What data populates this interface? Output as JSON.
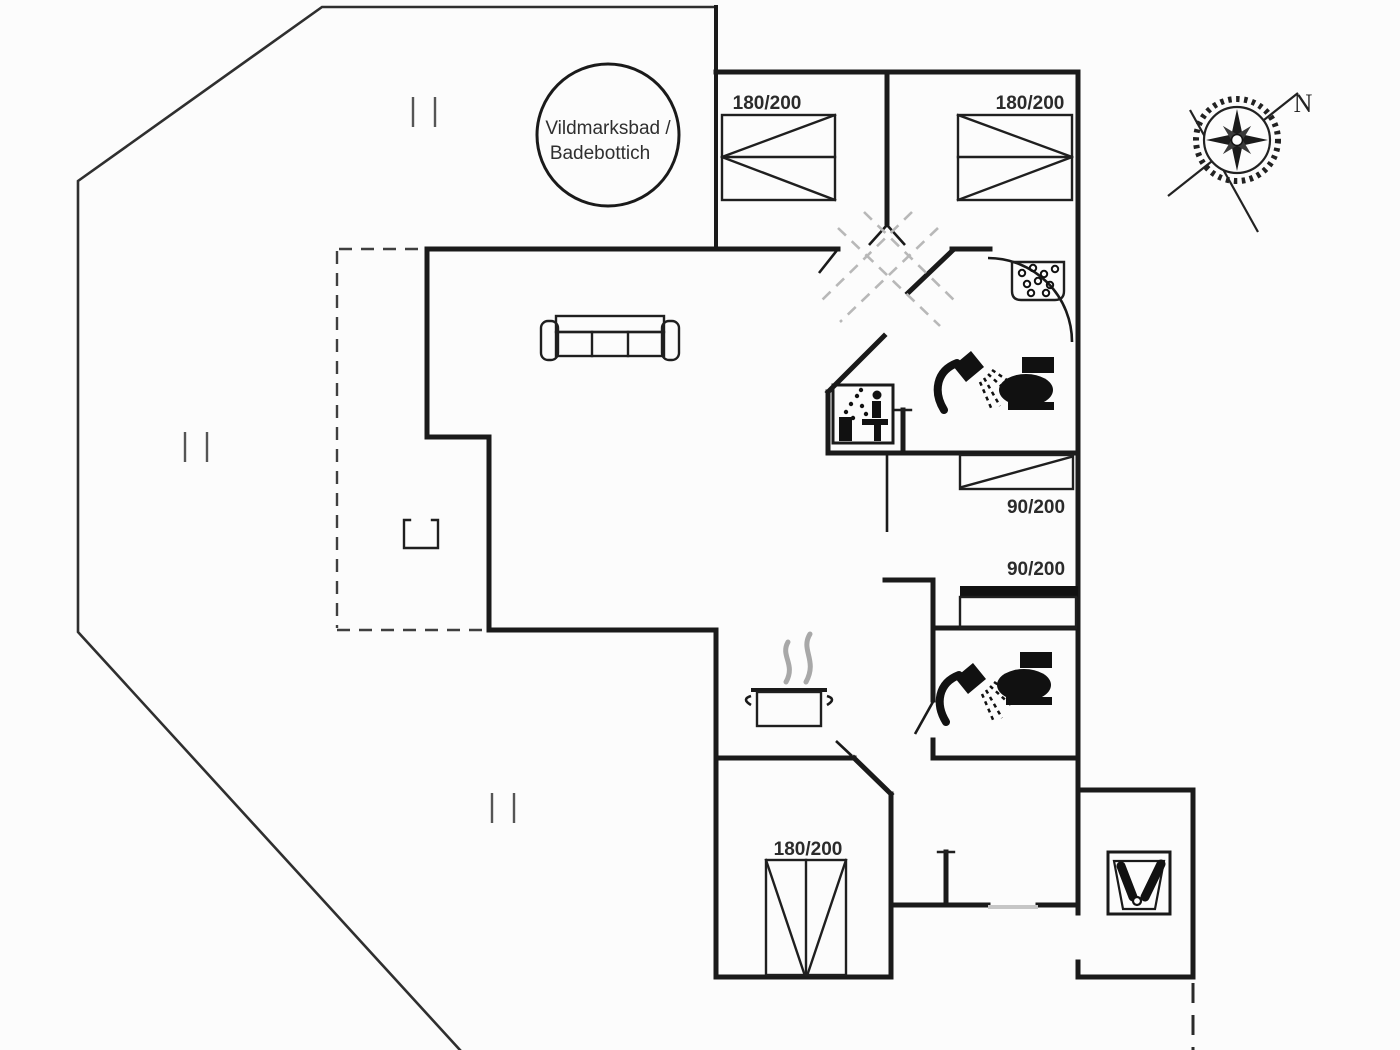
{
  "floor_plan": {
    "labels": {
      "hot_tub_line1": "Vildmarksbad /",
      "hot_tub_line2": "Badebottich",
      "compass_north": "N",
      "bed_bedroom1": "180/200",
      "bed_bedroom2": "180/200",
      "bed_room3_upper": "90/200",
      "bed_room3_lower": "90/200",
      "bed_bedroom3": "180/200"
    },
    "icons": {
      "hot_tub": "large-circle",
      "compass_rose": "eight-point-star-with-needles",
      "sofa": "three-seat-outline",
      "fireplace": "open-top-square",
      "cooking_pot": "pot-with-steam",
      "shower": "handheld-shower-with-spray",
      "toilet": "black-toilet-silhouette",
      "washbasin": "basin-with-bubbles",
      "sauna": "person-with-steam-box",
      "boots_tray": "two-boots-in-tray"
    },
    "colors": {
      "wall": "#1a1a1a",
      "deck_line": "#2f2f2f",
      "terrace_dash": "#3f3f3f",
      "skylight_dash": "#b8b8b8",
      "steam": "#a8a8a8",
      "threshold": "#c6c6c6",
      "icon_fill": "#111111",
      "label_text": "#2b2b2b",
      "background": "#fcfcfc"
    }
  }
}
